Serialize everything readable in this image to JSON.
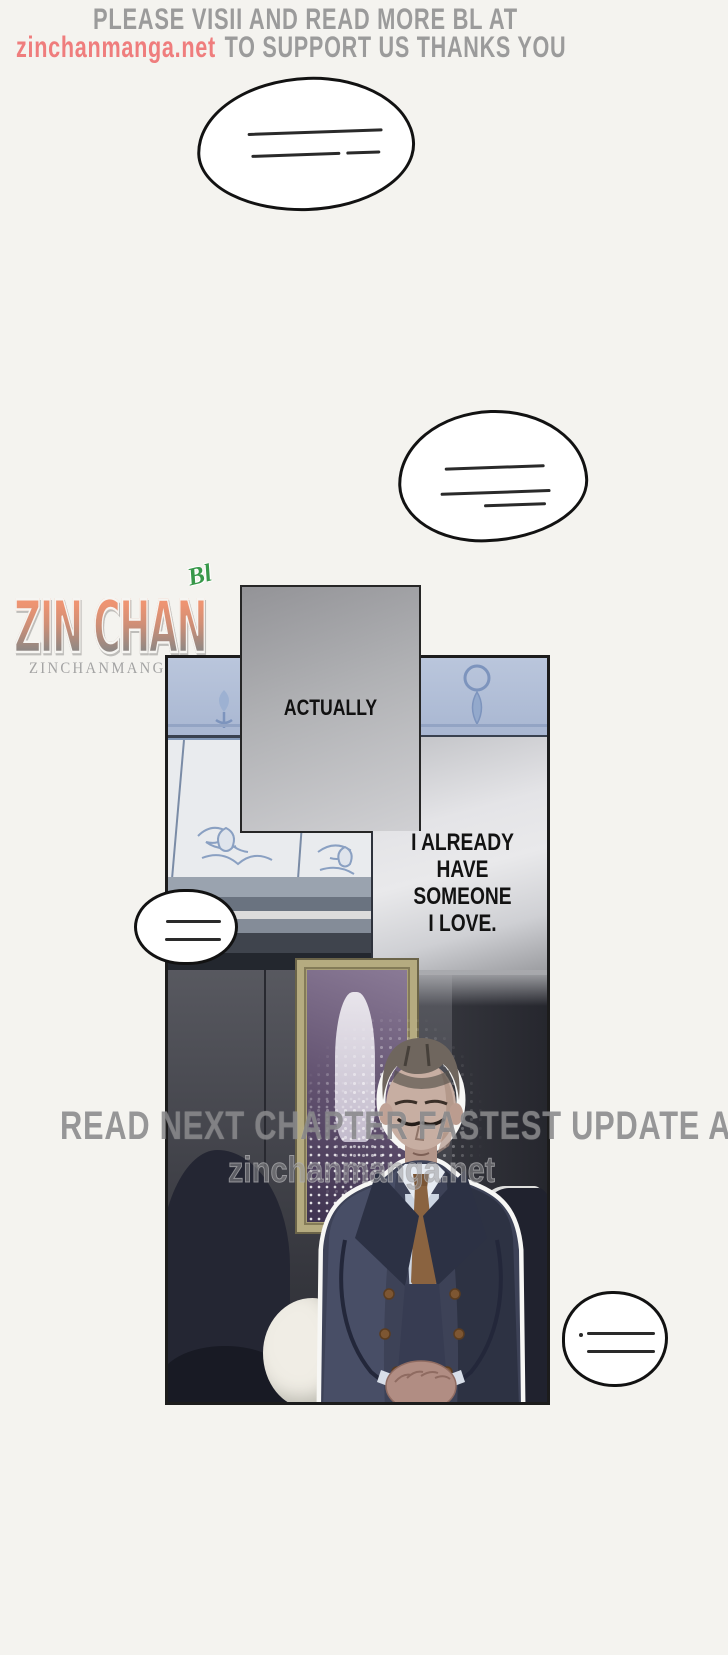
{
  "header": {
    "line1": "PLEASE VISII AND READ MORE BL AT",
    "link": "zinchanmanga.net",
    "line2_rest": "TO SUPPORT US THANKS YOU",
    "text_color": "#9b9b9b",
    "link_color": "#ef7d7d"
  },
  "logo": {
    "title": "ZIN CHAN",
    "badge": "Bl",
    "subtitle": "ZINCHANMANGA.NET",
    "badge_color": "#38984a",
    "gradient_top": "#ee9472",
    "gradient_bottom": "#8f8884"
  },
  "panel": {
    "caption1": "ACTUALLY",
    "caption2": {
      "lines": [
        "I ALREADY",
        "HAVE",
        "SOMEONE",
        "I LOVE."
      ]
    }
  },
  "watermark": {
    "line1": "READ NEXT CHAPTER FASTEST UPDATE AT",
    "line2": "zinchanmanga.net"
  },
  "speech_bubbles": [
    {
      "id": "bubble-top",
      "content": "redacted",
      "redacted_lines": 2
    },
    {
      "id": "bubble-mid",
      "content": "redacted",
      "redacted_lines": 3
    },
    {
      "id": "bubble-left",
      "content": "redacted",
      "redacted_lines": 2
    },
    {
      "id": "bubble-bottom",
      "content": "redacted",
      "redacted_lines": 2
    }
  ],
  "art_colors": {
    "suit": "#3d4257",
    "tie": "#8a6340",
    "shirt": "#ccd5e2",
    "wall_frieze_blue": "#b7c3d9",
    "frame_gold": "#aaa077",
    "painting_purple": "#5f4f6d",
    "couch_dark": "#242633",
    "page_background": "#f4f3ef"
  }
}
